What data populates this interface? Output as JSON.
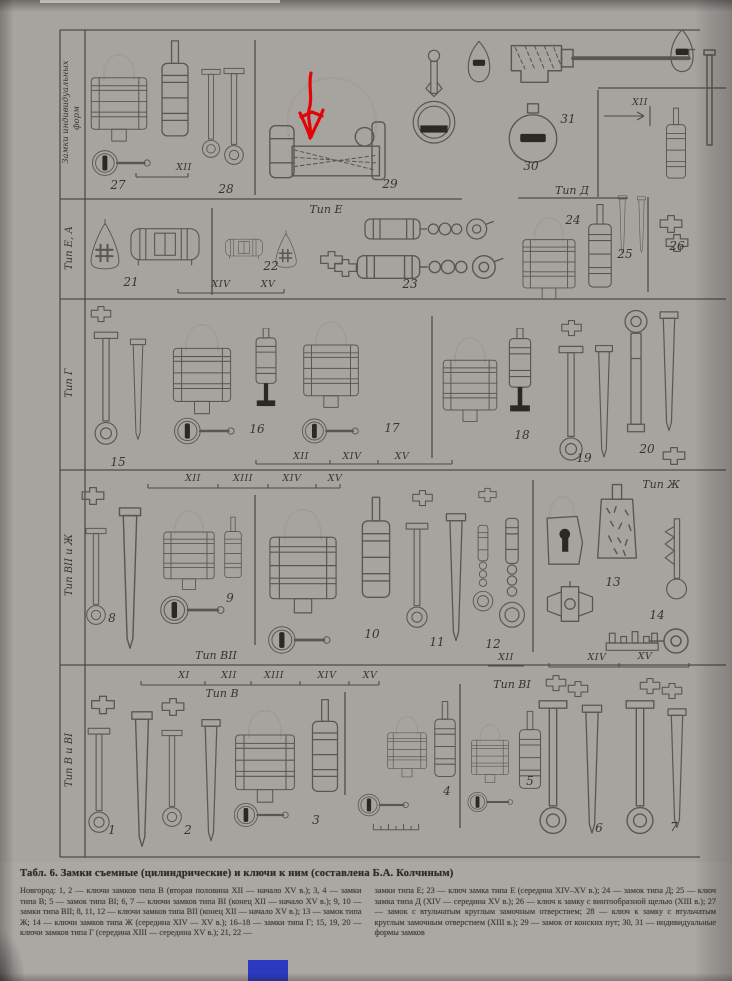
{
  "caption": {
    "title": "Табл. 6. Замки съемные (цилиндрические) и ключи к ним (составлена Б.А. Колчиным)",
    "left_column": "Новгород: 1, 2 — ключи замков типа В (вторая половина XII — начало XV в.); 3, 4 — замки типа В; 5 — замок типа ВI; 6, 7 — ключи замков типа ВI (конец XII — начало XV в.); 9, 10 — замки типа ВII; 8, 11, 12 — ключи замков типа ВII (конец XII — начало XV в.); 13 — замок типа Ж; 14 — ключи замков типа Ж (середина XIV — XV в.); 16–18 — замки типа Г; 15, 19, 20 — ключи замков типа Г (середина XIII — середина XV в.); 21, 22 —",
    "right_column": "замки типа Е; 23 — ключ замка типа Е (середина XIV–XV в.); 24 — замок типа Д; 25 — ключ замка типа Д (XIV — середина XV в.); 26 — ключ к замку с винтообразной щелью (XIII в.); 27 — замок с втульчатым круглым замочным отверстием; 28 — ключ к замку с втульчатым круглым замочным отверстием (XIII в.); 29 — замок от конских пут; 30, 31 — индивидуальные формы замков"
  },
  "figure": {
    "side_labels": [
      {
        "lines": [
          "Замки индивидуальных",
          "форм"
        ]
      },
      {
        "lines": [
          "Тип Е, А"
        ]
      },
      {
        "lines": [
          "Тип Г"
        ]
      },
      {
        "lines": [
          "Тип ВII и Ж"
        ]
      },
      {
        "lines": [
          "Тип В и ВI"
        ]
      }
    ],
    "type_labels": {
      "tip_e": "Тип Е",
      "tip_d": "Тип Д",
      "tip_zh": "Тип Ж",
      "tip_v2": "Тип ВII",
      "tip_v": "Тип В",
      "tip_v1": "Тип ВI"
    },
    "centuries": {
      "XI": "XI",
      "XII": "XII",
      "XIII": "XIII",
      "XIV": "XIV",
      "XV": "XV"
    },
    "item_numbers": [
      "1",
      "2",
      "3",
      "4",
      "5",
      "6",
      "7",
      "8",
      "9",
      "10",
      "11",
      "12",
      "13",
      "14",
      "15",
      "16",
      "17",
      "18",
      "19",
      "20",
      "21",
      "22",
      "23",
      "24",
      "25",
      "26",
      "27",
      "28",
      "29",
      "30",
      "31"
    ]
  },
  "annotation": {
    "color": "#e30505",
    "shape": "hand-drawn down arrow",
    "points_at_item": "29"
  },
  "artifacts": {
    "blue_marker_color": "#2c3ac0"
  }
}
